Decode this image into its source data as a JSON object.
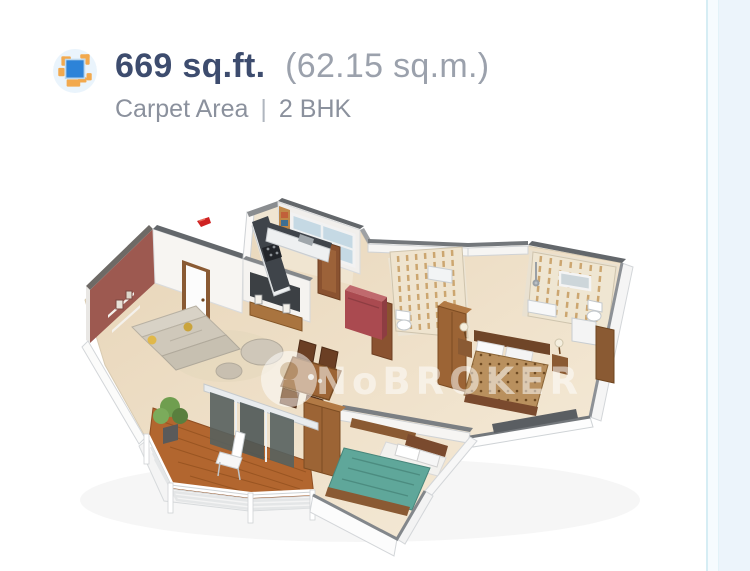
{
  "page": {
    "background": "#ecf4fb",
    "card_background": "#ffffff",
    "divider_color": "#d6edf4"
  },
  "header": {
    "area_icon": "area-dimension-icon",
    "area_sqft": "669 sq.ft.",
    "area_sqm": "(62.15 sq.m.)",
    "carpet_area_label": "Carpet Area",
    "separator": "|",
    "bhk_label": "2 BHK",
    "title_color": "#3d4c6e",
    "subtitle_color": "#8b919d"
  },
  "floorplan": {
    "type": "3d-isometric-floor-plan",
    "watermark": {
      "logo": "nobroker-logo",
      "text": "NoBROKER"
    },
    "marker": "red-direction-marker",
    "rooms_depicted": [
      "living-room",
      "dining-area",
      "kitchen",
      "balcony",
      "bedroom-teal-bed",
      "master-bedroom",
      "bathroom-common",
      "bathroom-attached"
    ],
    "colors": {
      "accent_wall": "#9d5950",
      "floor": "#ecdcc0",
      "teal_bed": "#5fa79a",
      "master_bed_cover": "#b9905e",
      "refrigerator": "#aa4a50",
      "balcony_deck": "#b2662f",
      "walls": "#ffffff"
    }
  }
}
